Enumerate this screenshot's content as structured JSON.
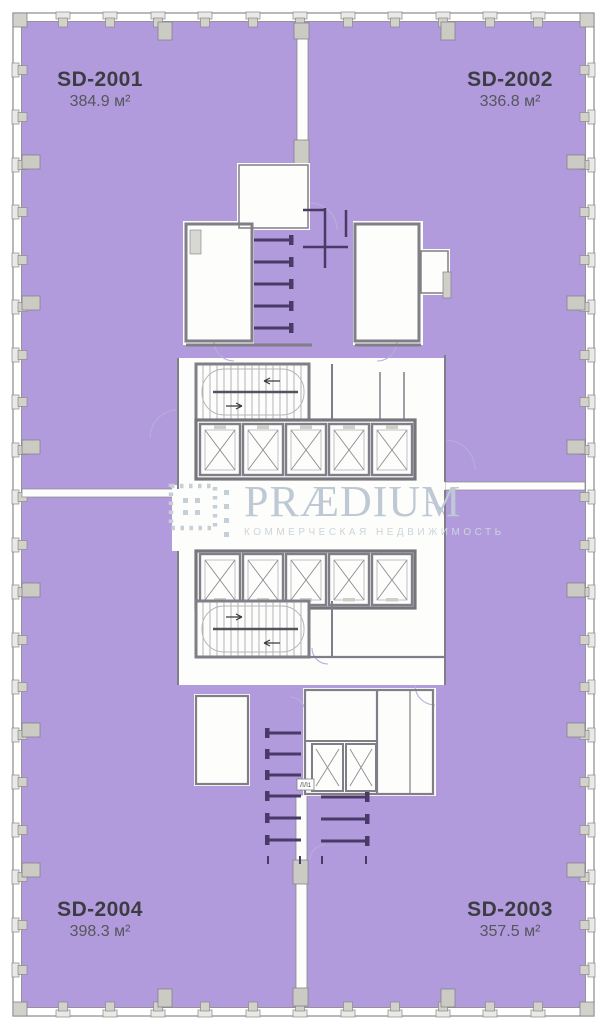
{
  "plan": {
    "units": [
      {
        "id": "SD-2001",
        "area": "384.9 м²"
      },
      {
        "id": "SD-2002",
        "area": "336.8 м²"
      },
      {
        "id": "SD-2003",
        "area": "357.5 м²"
      },
      {
        "id": "SD-2004",
        "area": "398.3 м²"
      }
    ],
    "stair_tag": "ЛЛ1"
  },
  "watermark": {
    "brand": "PRÆDIUM",
    "tagline": "КОММЕРЧЕСКАЯ НЕДВИЖИМОСТЬ"
  },
  "colors": {
    "unit_fill": "#b19bdc",
    "wall": "#807e86",
    "partition": "#4a3a68",
    "unit_label": "#3c3c42",
    "unit_area_label": "#55555c",
    "watermark_text": "#bec9d3"
  }
}
